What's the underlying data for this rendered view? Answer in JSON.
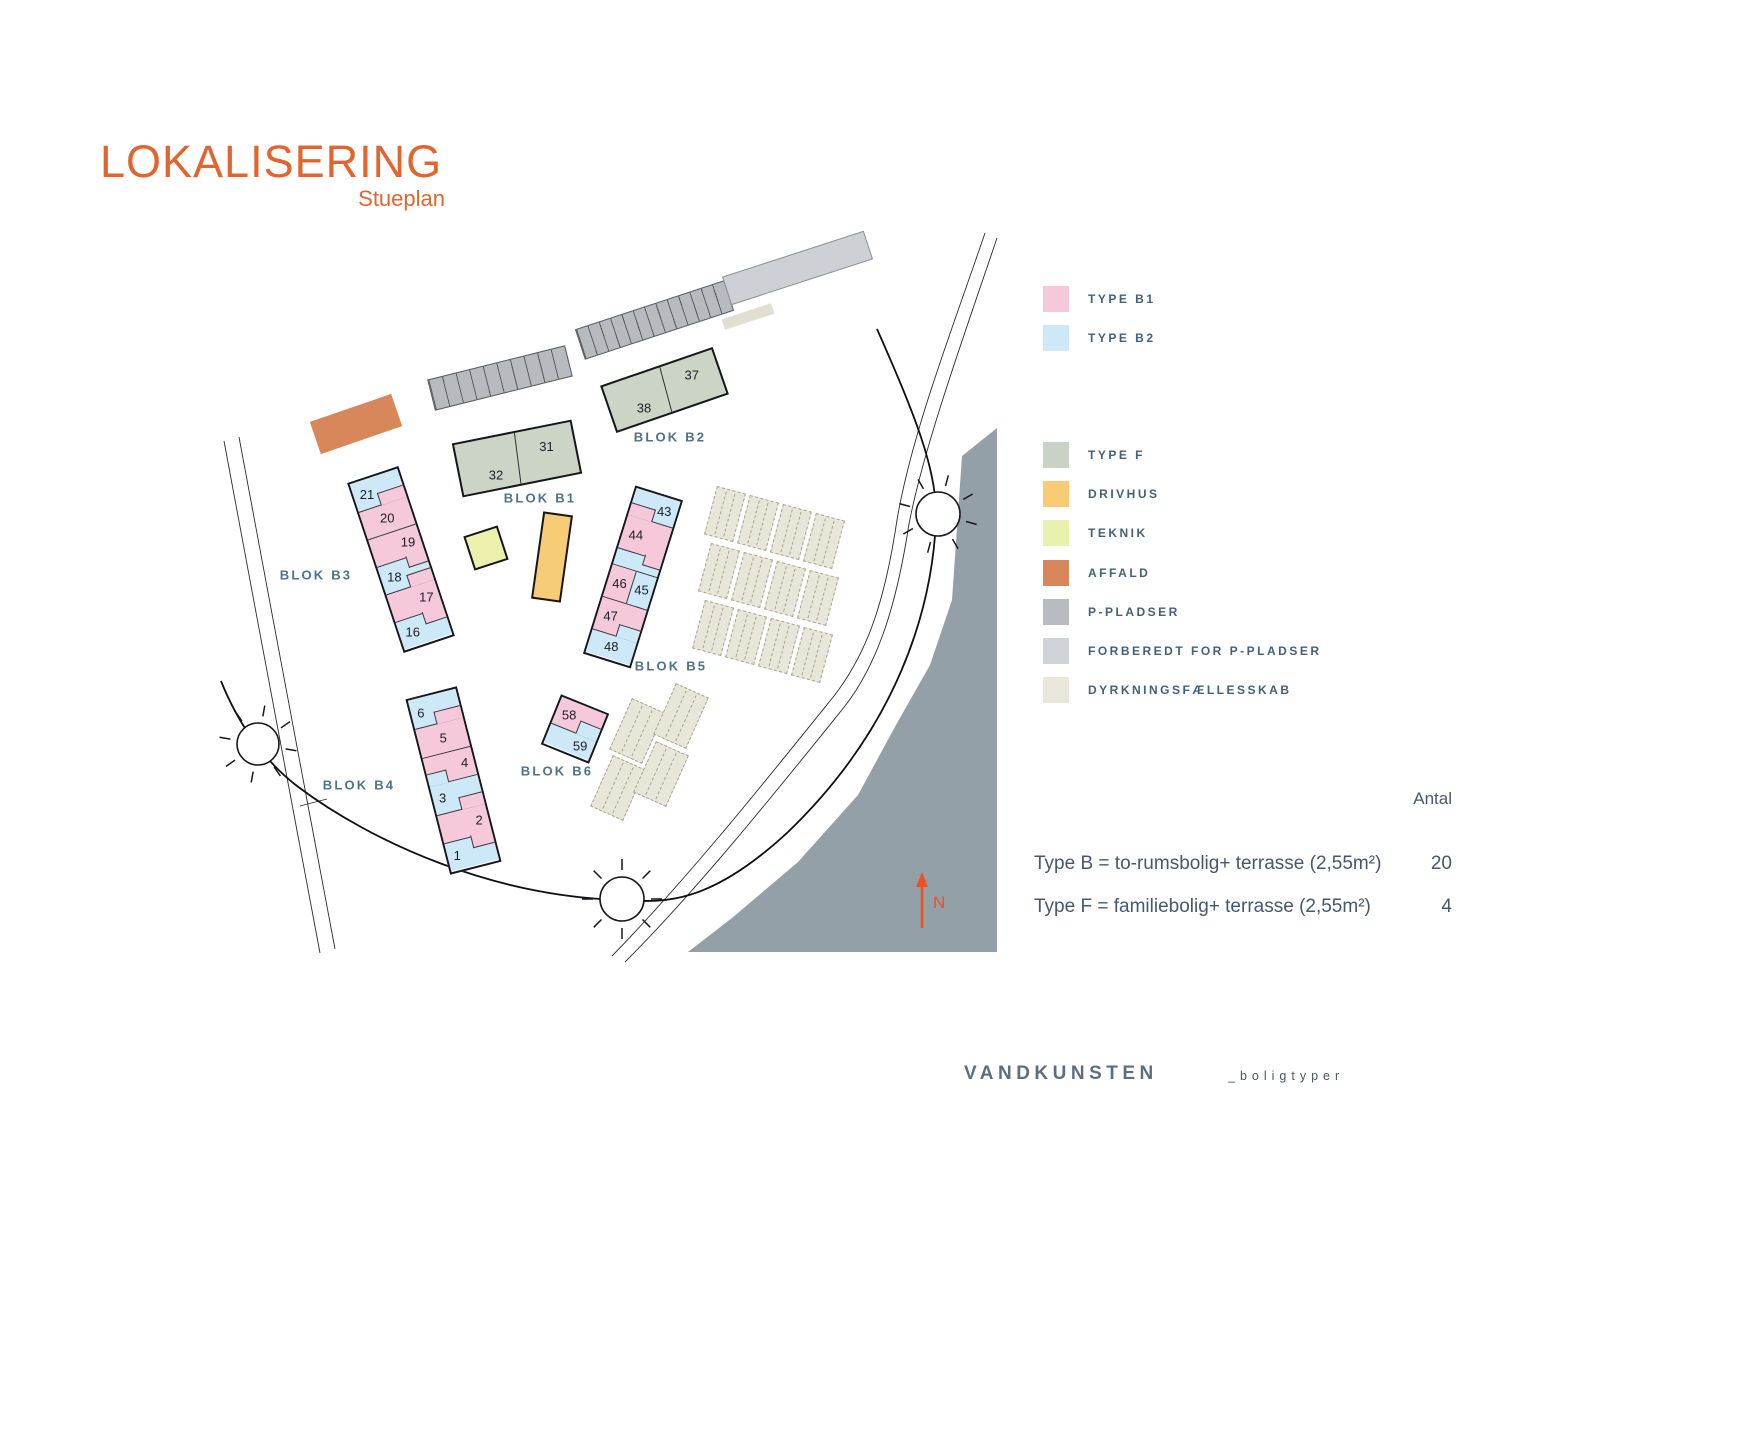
{
  "title": {
    "main": "LOKALISERING",
    "sub": "Stueplan"
  },
  "legend": {
    "groups": [
      {
        "items": [
          {
            "label": "TYPE B1",
            "color": "#f5c8da"
          },
          {
            "label": "TYPE  B2",
            "color": "#cde9f8"
          }
        ]
      },
      {
        "items": [
          {
            "label": "TYPE F",
            "color": "#c9d2c4"
          },
          {
            "label": "DRIVHUS",
            "color": "#f8cc74"
          },
          {
            "label": "TEKNIK",
            "color": "#e9f2ac"
          },
          {
            "label": "AFFALD",
            "color": "#d8875a"
          },
          {
            "label": "P-PLADSER",
            "color": "#b8bbbf"
          },
          {
            "label": "FORBEREDT FOR P-PLADSER",
            "color": "#cfd2d6"
          },
          {
            "label": "DYRKNINGSFÆLLESSKAB",
            "color": "#e8e7da"
          }
        ]
      }
    ]
  },
  "type_colors": {
    "B1": "#f5c8da",
    "B2": "#cde9f8",
    "F": "#ccd4c6"
  },
  "plan": {
    "blocks": [
      {
        "id": "B1",
        "label": "BLOK B1",
        "kind": "duo",
        "units": [
          {
            "no": "32"
          },
          {
            "no": "31"
          }
        ]
      },
      {
        "id": "B2",
        "label": "BLOK B2",
        "kind": "duo",
        "units": [
          {
            "no": "38"
          },
          {
            "no": "37"
          }
        ]
      },
      {
        "id": "B3",
        "label": "BLOK B3",
        "kind": "row",
        "units": [
          {
            "no": "21",
            "type": "B2"
          },
          {
            "no": "20",
            "type": "B1"
          },
          {
            "no": "19",
            "type": "B1"
          },
          {
            "no": "18",
            "type": "B2"
          },
          {
            "no": "17",
            "type": "B1"
          },
          {
            "no": "16",
            "type": "B2"
          }
        ]
      },
      {
        "id": "B4",
        "label": "BLOK B4",
        "kind": "row",
        "units": [
          {
            "no": "6",
            "type": "B2"
          },
          {
            "no": "5",
            "type": "B1"
          },
          {
            "no": "4",
            "type": "B1"
          },
          {
            "no": "3",
            "type": "B2"
          },
          {
            "no": "2",
            "type": "B1"
          },
          {
            "no": "1",
            "type": "B2"
          }
        ]
      },
      {
        "id": "B5",
        "label": "BLOK B5",
        "kind": "row",
        "units": [
          {
            "no": "43",
            "type": "B2"
          },
          {
            "no": "44",
            "type": "B1"
          },
          {
            "no": "45",
            "type": "B2"
          },
          {
            "no": "46",
            "type": "B1"
          },
          {
            "no": "47",
            "type": "B1"
          },
          {
            "no": "48",
            "type": "B2"
          }
        ]
      },
      {
        "id": "B6",
        "label": "BLOK B6",
        "kind": "row",
        "units": [
          {
            "no": "58",
            "type": "B1"
          },
          {
            "no": "59",
            "type": "B2"
          }
        ]
      }
    ],
    "parking_rows": [
      {
        "stalls": 10
      },
      {
        "stalls": 13
      }
    ],
    "features": {
      "affald": "AFFALD",
      "teknik": "TEKNIK",
      "drivhus": "DRIVHUS",
      "prepared": "FORBEREDT FOR P-PLADSER",
      "gardens": "DYRKNINGSFÆLLESSKAB"
    }
  },
  "summary": {
    "antal_header": "Antal",
    "rows": [
      {
        "label": "Type B = to-rumsbolig+ terrasse (2,55m²)",
        "value": "20"
      },
      {
        "label": "Type F = familiebolig+ terrasse (2,55m²)",
        "value": "4"
      }
    ]
  },
  "footer": {
    "brand": "VANDKUNSTEN",
    "suffix": "_boligtyper"
  },
  "north": {
    "label": "N"
  }
}
